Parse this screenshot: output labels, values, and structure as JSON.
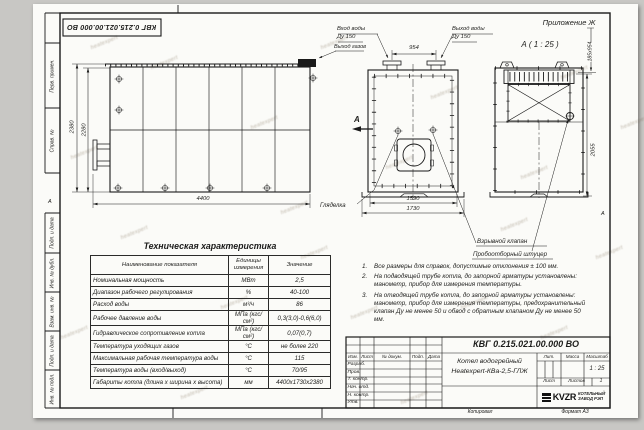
{
  "sheet": {
    "doc_number": "КВГ 0.215.021.00.000 ВО",
    "appendix": "Приложение Ж",
    "zone_letter": "А",
    "copied_label": "Копировал",
    "format_label": "Формат А3",
    "watermark": "heatexpert",
    "colors": {
      "ink": "#1d1d1b",
      "paper": "#fbfbf8",
      "background": "#c8c7c4"
    }
  },
  "margin": {
    "items": [
      "Перв. примен.",
      "Справ. №",
      "Подп. и дата",
      "Инв. № дубл.",
      "Взам. инв. №",
      "Подп. и дата",
      "Инв. № подл."
    ]
  },
  "views": {
    "side": {
      "dim_height_outer": "2380",
      "dim_height_inner": "2280",
      "dim_length": "4400"
    },
    "front": {
      "inlet_label": "Вход воды",
      "inlet_size": "Ду 150",
      "outlet_label": "Выход воды",
      "outlet_size": "Ду 150",
      "gas_label": "Выход газов",
      "dim_nozzles": "954",
      "dim_width_inner": "1590",
      "dim_width_outer": "1730",
      "section_letter": "А",
      "peephole_label": "Гляделка"
    },
    "section_a": {
      "title": "А ( 1 : 25 )",
      "dim_band": "185х954",
      "dim_height": "2055",
      "explosion_valve_label": "Взрывной клапан",
      "sampling_label": "Пробоотборный штуцер"
    }
  },
  "spec_table": {
    "title": "Техническая характеристика",
    "headers": [
      "Наименование показателя",
      "Единицы измерения",
      "Значение"
    ],
    "rows": [
      [
        "Номинальная мощность",
        "МВт",
        "2,5"
      ],
      [
        "Диапазон рабочего регулирования",
        "%",
        "40-100"
      ],
      [
        "Расход воды",
        "м³/ч",
        "86"
      ],
      [
        "Рабочее давление воды",
        "МПа (кгс/см²)",
        "0,3(3,0)-0,6(6,0)"
      ],
      [
        "Гидравлическое сопротивление котла",
        "МПа (кгс/см²)",
        "0,07(0,7)"
      ],
      [
        "Температура уходящих газов",
        "°С",
        "не более 220"
      ],
      [
        "Максимальная рабочая температура воды",
        "°С",
        "115"
      ],
      [
        "Температура воды (вход/выход)",
        "°С",
        "70/95"
      ],
      [
        "Габариты котла (длина х ширина х высота)",
        "мм",
        "4400х1730х2380"
      ]
    ]
  },
  "notes": {
    "items": [
      {
        "num": "1.",
        "text": "Все размеры для справок, допустимые отклонения ± 100 мм."
      },
      {
        "num": "2.",
        "text": "На подводящей трубе котла, до запорной арматуры установлены: манометр, прибор для измерения температуры."
      },
      {
        "num": "3.",
        "text": "На отводящей трубе котла, до запорной арматуры установлены: манометр, прибор для измерения температуры, предохранительный клапан Ду не менее 50 и обвод с обратным клапаном Ду не менее 50 мм."
      }
    ]
  },
  "title_block": {
    "doc_number": "КВГ 0.215.021.00.000 ВО",
    "product_name_line1": "Котел водогрейный",
    "product_name_line2": "Heatexpert-КВа-2,5-ГЛЖ",
    "header_cols": [
      "Изм.",
      "Лист",
      "№ докум.",
      "Подп.",
      "Дата"
    ],
    "sign_rows": [
      "Разраб.",
      "Пров.",
      "Т. контр.",
      "Нач. отд.",
      "Н. контр.",
      "Утв."
    ],
    "lit_label": "Лит.",
    "mass_label": "Масса",
    "scale_label": "Масштаб",
    "scale_value": "1 : 25",
    "sheet_label": "Лист",
    "sheets_label": "Листов",
    "sheets_value": "1",
    "logo_text": "KVZR",
    "org_line1": "КОТЕЛЬНЫЙ",
    "org_line2": "ЗАВОД РЭП"
  }
}
